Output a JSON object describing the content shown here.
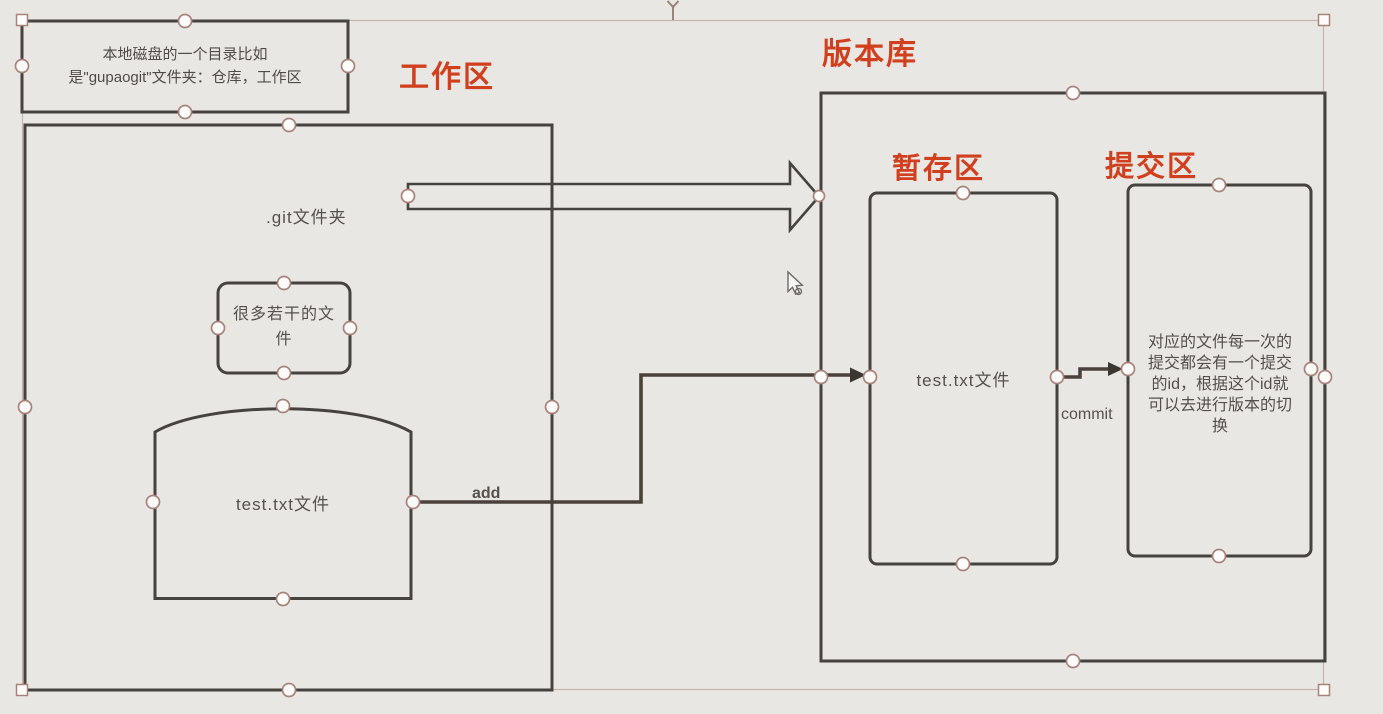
{
  "titles": {
    "work_area": "工作区",
    "repository": "版本库",
    "staging_area": "暂存区",
    "commit_area": "提交区"
  },
  "notes": {
    "local_disk": "本地磁盘的一个目录比如\n是\"gupaogit\"文件夹：仓库，工作区",
    "commit_id": "对应的文件每一次的\n提交都会有一个提交\n的id，根据这个id就\n可以去进行版本的切\n换"
  },
  "labels": {
    "git_folder": ".git文件夹",
    "many_files": "很多若干的文\n件",
    "worktree_file": "test.txt文件",
    "staged_file": "test.txt文件",
    "add_arrow": "add",
    "commit_arrow": "commit"
  },
  "icons": {
    "cursor": "arrow-cursor"
  },
  "colors": {
    "background": "#e9e7e4",
    "shape_border": "#454240",
    "title_red": "#d1401e",
    "label_gray": "#54504d",
    "arrow_line": "#4a413a",
    "selection_line": "#c6b4ab",
    "handle_stroke": "#a8837a",
    "handle_fill": "#fdfcfa"
  }
}
